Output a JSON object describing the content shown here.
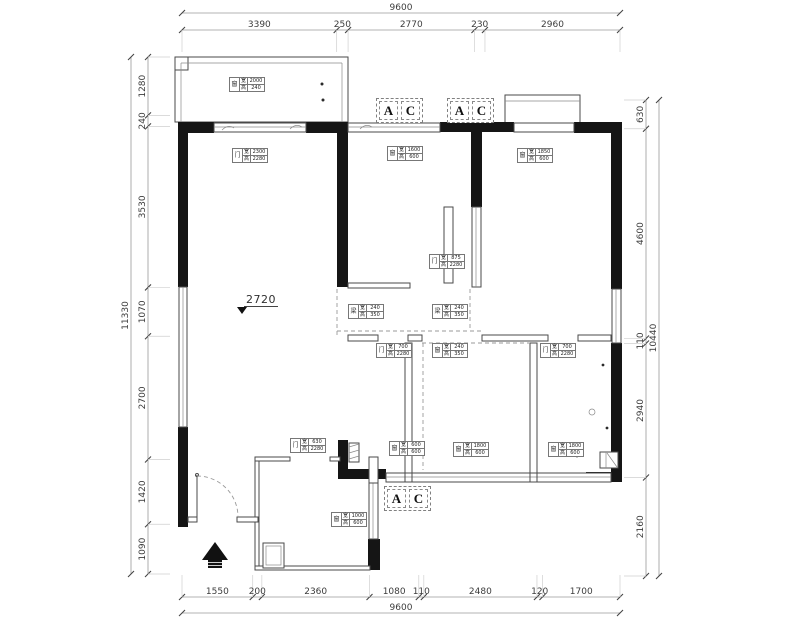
{
  "dim_chains": {
    "top": {
      "total": "9600",
      "segments": [
        "3390",
        "250",
        "2770",
        "230",
        "2960"
      ]
    },
    "bottom": {
      "total": "9600",
      "segments": [
        "1550",
        "200",
        "2360",
        "1080",
        "110",
        "2480",
        "120",
        "1700"
      ]
    },
    "left": {
      "total": "11330",
      "segments": [
        "1280",
        "240",
        "3530",
        "1070",
        "2700",
        "1420",
        "1090"
      ]
    },
    "right": {
      "total": "10440",
      "segments": [
        "630",
        "4600",
        "110",
        "2940",
        "2160"
      ]
    }
  },
  "level_marker": "2720",
  "ac_label": {
    "a": "A",
    "c": "C"
  },
  "tag_field_labels": {
    "w": "宽",
    "h": "高"
  },
  "tags": [
    {
      "id": "balcony-window",
      "symbol": "窗",
      "w": "2000",
      "h": "240"
    },
    {
      "id": "living-balcony-door",
      "symbol": "门",
      "w": "2300",
      "h": "2280"
    },
    {
      "id": "bedroom1-window",
      "symbol": "窗",
      "w": "1600",
      "h": "600"
    },
    {
      "id": "bedroom2-window",
      "symbol": "窗",
      "w": "1850",
      "h": "600"
    },
    {
      "id": "bedroom1-door",
      "symbol": "门",
      "w": "875",
      "h": "2280"
    },
    {
      "id": "beam-left",
      "symbol": "梁",
      "w": "240",
      "h": "350"
    },
    {
      "id": "beam-right",
      "symbol": "梁",
      "w": "240",
      "h": "350"
    },
    {
      "id": "bathroom-door",
      "symbol": "门",
      "w": "700",
      "h": "2280"
    },
    {
      "id": "middle-window",
      "symbol": "窗",
      "w": "240",
      "h": "350"
    },
    {
      "id": "bedroom3-door",
      "symbol": "门",
      "w": "700",
      "h": "2280"
    },
    {
      "id": "bathroom-window",
      "symbol": "窗",
      "w": "600",
      "h": "600"
    },
    {
      "id": "middleroom-window",
      "symbol": "窗",
      "w": "1800",
      "h": "600"
    },
    {
      "id": "bedroom3-window",
      "symbol": "窗",
      "w": "1800",
      "h": "600"
    },
    {
      "id": "kitchen-door",
      "symbol": "门",
      "w": "630",
      "h": "2280"
    },
    {
      "id": "kitchen-window",
      "symbol": "窗",
      "w": "1000",
      "h": "600"
    }
  ],
  "colors": {
    "wall": "#151515",
    "thin_line": "#4a4a4a",
    "dim_text": "#3c3c3c",
    "background": "#ffffff"
  }
}
